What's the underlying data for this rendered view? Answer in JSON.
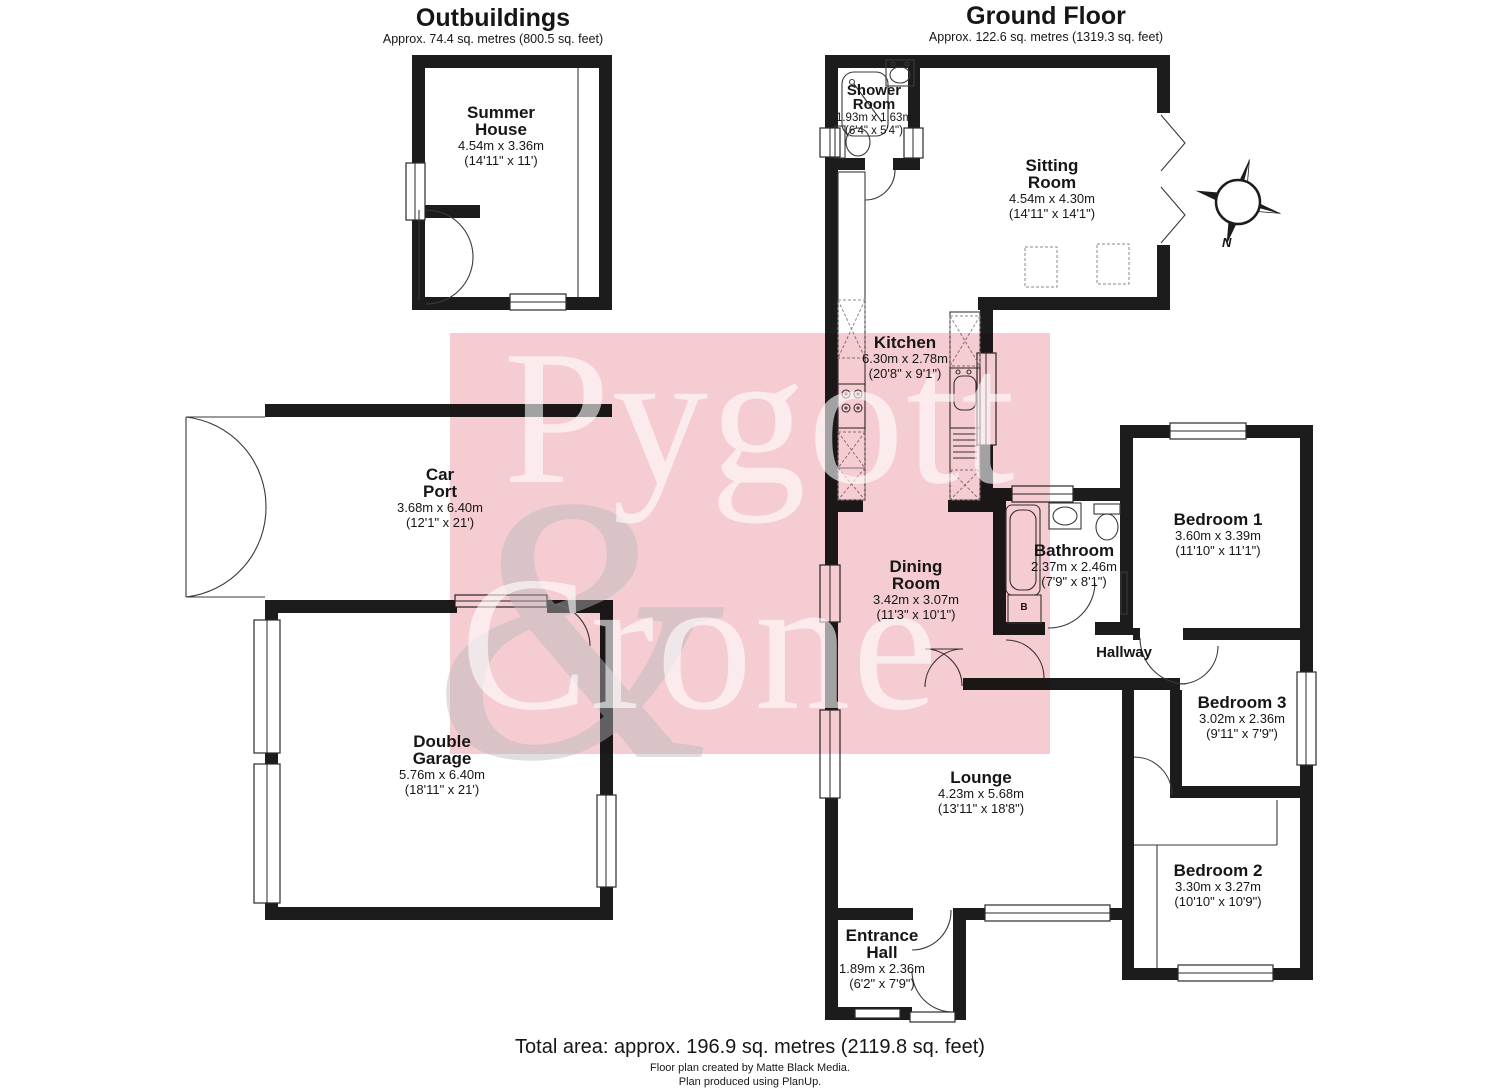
{
  "titles": {
    "outbuildings": {
      "title": "Outbuildings",
      "subtitle": "Approx. 74.4 sq. metres (800.5 sq. feet)"
    },
    "ground_floor": {
      "title": "Ground Floor",
      "subtitle": "Approx. 122.6 sq. metres (1319.3 sq. feet)"
    }
  },
  "rooms": {
    "summer_house": {
      "name": "Summer\nHouse",
      "metric": "4.54m x 3.36m",
      "imperial": "(14'11\" x 11')"
    },
    "car_port": {
      "name": "Car\nPort",
      "metric": "3.68m x 6.40m",
      "imperial": "(12'1\" x 21')"
    },
    "double_garage": {
      "name": "Double\nGarage",
      "metric": "5.76m x 6.40m",
      "imperial": "(18'11\" x 21')"
    },
    "shower_room": {
      "name": "Shower\nRoom",
      "metric": "1.93m x 1.63m",
      "imperial": "(6'4\" x 5'4\")"
    },
    "sitting_room": {
      "name": "Sitting\nRoom",
      "metric": "4.54m x 4.30m",
      "imperial": "(14'11\" x 14'1\")"
    },
    "kitchen": {
      "name": "Kitchen",
      "metric": "6.30m x 2.78m",
      "imperial": "(20'8\" x 9'1\")"
    },
    "dining_room": {
      "name": "Dining\nRoom",
      "metric": "3.42m x 3.07m",
      "imperial": "(11'3\" x 10'1\")"
    },
    "bathroom": {
      "name": "Bathroom",
      "metric": "2.37m x 2.46m",
      "imperial": "(7'9\" x 8'1\")"
    },
    "hallway": {
      "name": "Hallway"
    },
    "bedroom_1": {
      "name": "Bedroom 1",
      "metric": "3.60m x 3.39m",
      "imperial": "(11'10\" x 11'1\")"
    },
    "bedroom_3": {
      "name": "Bedroom 3",
      "metric": "3.02m x 2.36m",
      "imperial": "(9'11\" x 7'9\")"
    },
    "bedroom_2": {
      "name": "Bedroom 2",
      "metric": "3.30m x 3.27m",
      "imperial": "(10'10\" x 10'9\")"
    },
    "lounge": {
      "name": "Lounge",
      "metric": "4.23m x 5.68m",
      "imperial": "(13'11\" x 18'8\")"
    },
    "entrance_hall": {
      "name": "Entrance\nHall",
      "metric": "1.89m x 2.36m",
      "imperial": "(6'2\" x 7'9\")"
    }
  },
  "annotations": {
    "boiler": "B",
    "compass_north": "N"
  },
  "watermark": {
    "line1": "Pygott",
    "line2": "Crone",
    "ampersand": "&",
    "pink": "#f5ccd1"
  },
  "footer": {
    "total": "Total area: approx. 196.9 sq. metres (2119.8 sq. feet)",
    "credit1": "Floor plan created by Matte Black Media.",
    "credit2": "Plan produced using PlanUp."
  }
}
